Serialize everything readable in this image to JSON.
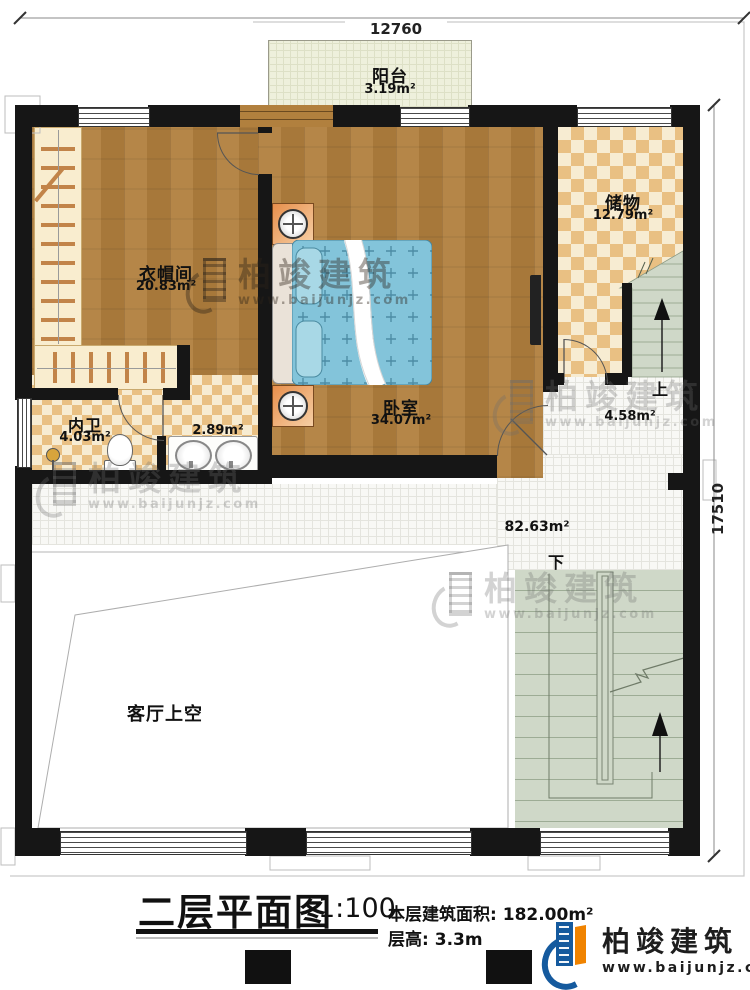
{
  "dimensions": {
    "top": "12760",
    "right": "17510"
  },
  "rooms": {
    "balcony": {
      "name": "阳台",
      "area": "3.19m²"
    },
    "cloakroom": {
      "name": "衣帽间",
      "area": "20.83m²"
    },
    "bedroom": {
      "name": "卧室",
      "area": "34.07m²"
    },
    "storage": {
      "name": "储物",
      "area": "12.79m²"
    },
    "bathroom": {
      "name": "内卫",
      "area": "4.03m²"
    },
    "sink_area": {
      "area": "2.89m²"
    },
    "landing": {
      "area": "4.58m²"
    },
    "hall": {
      "area": "82.63m²"
    },
    "void": {
      "name": "客厅上空"
    }
  },
  "stairs": {
    "up_label": "上",
    "down_label": "下"
  },
  "title_block": {
    "title": "二层平面图",
    "scale": "1:100",
    "floor_area_label": "本层建筑面积:",
    "floor_area_value": "182.00m²",
    "floor_height_label": "层高:",
    "floor_height_value": "3.3m"
  },
  "branding": {
    "company": "柏竣建筑",
    "website": "www.baijunjz.com"
  },
  "watermark": {
    "company": "柏竣建筑",
    "website": "www.baijunjz.com"
  },
  "colors": {
    "wall": "#161616",
    "wood": "#b1803e",
    "checkA": "#e9c083",
    "checkB": "#f7ecd2",
    "tile": "#f8f8f5",
    "stair": "#cfd8c8",
    "balcony": "#eef0dc",
    "bed": "#83c4da",
    "logoBlue": "#155a9e",
    "logoOrange": "#f08300"
  }
}
